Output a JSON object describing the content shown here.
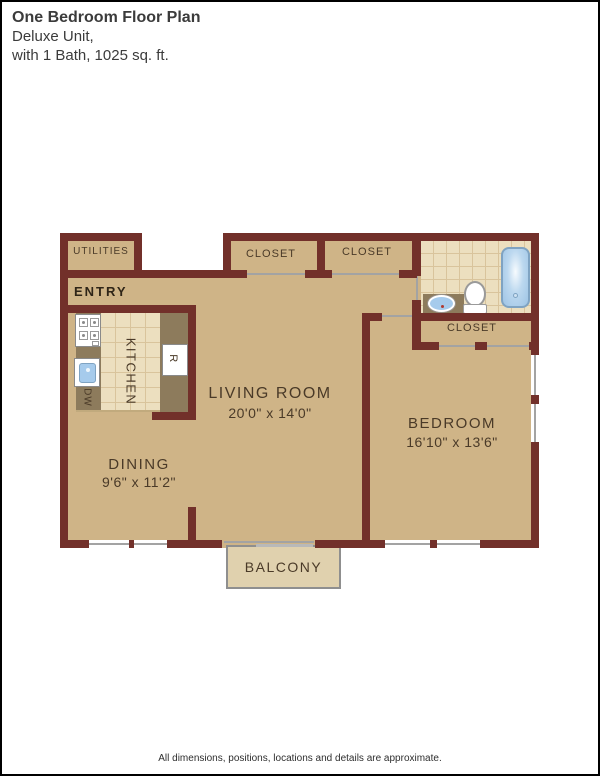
{
  "header": {
    "title": "One Bedroom Floor Plan",
    "subtitle1": "Deluxe Unit,",
    "subtitle2": "with 1 Bath, 1025 sq. ft."
  },
  "plan": {
    "entry": "ENTRY",
    "utilities": "UTILITIES",
    "closet": "CLOSET",
    "kitchen": "KITCHEN",
    "dishwasher": "DW",
    "refrigerator": "R",
    "living_room": {
      "name": "LIVING ROOM",
      "dims": "20'0\" x 14'0\""
    },
    "dining": {
      "name": "DINING",
      "dims": "9'6\" x 11'2\""
    },
    "bedroom": {
      "name": "BEDROOM",
      "dims": "16'10\" x 13'6\""
    },
    "balcony": "BALCONY"
  },
  "colors": {
    "wall": "#72302a",
    "floor": "#cfb487",
    "tile": "#ecdfbf",
    "counter": "#8d7b5c",
    "tub_blue": "#9ec4e5",
    "sink_blue": "#a6cbec",
    "balcony_fill": "#e0d1ae"
  },
  "footer": "All dimensions, positions, locations and details are approximate."
}
